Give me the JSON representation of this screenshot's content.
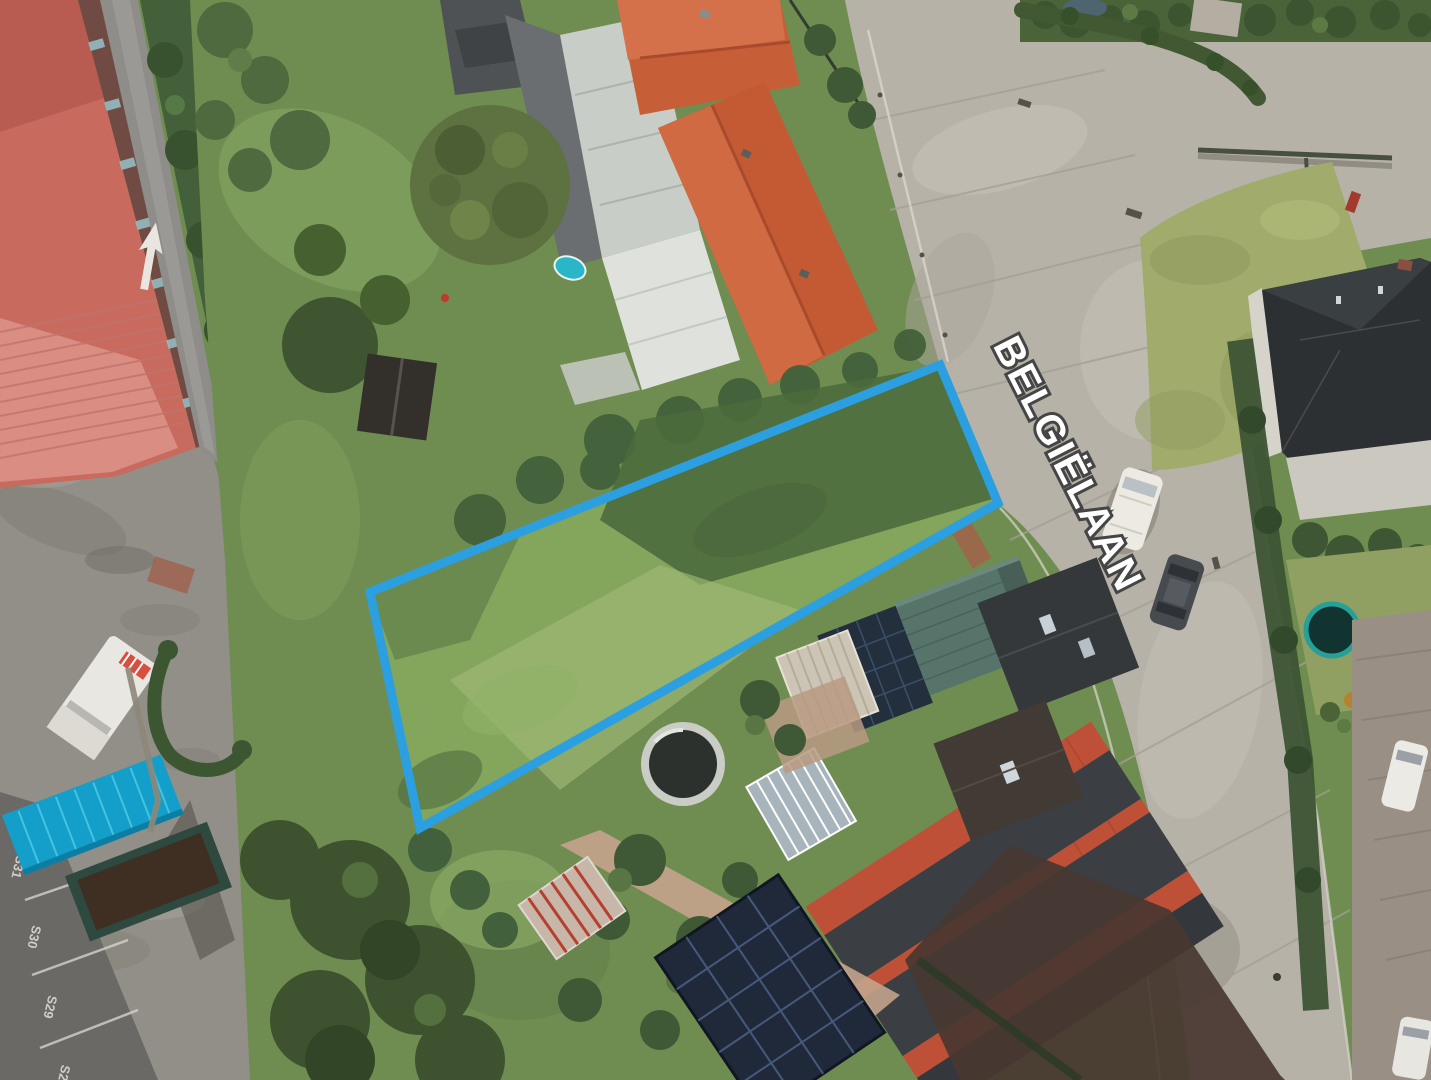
{
  "map": {
    "type": "aerial-photo",
    "labels": {
      "street": "BELGIËLAAN",
      "parking": [
        "S31",
        "S30",
        "S29",
        "S2"
      ]
    },
    "parcel": {
      "outline_color": "#2b9fe0"
    },
    "colors": {
      "road_light": "#b7b2a8",
      "road_dark": "#8e8d89",
      "grass": "#6f8d50",
      "parcel_grass": "#84a55c",
      "roof_orange": "#c45a34",
      "roof_industrial_red": "#c96a5e",
      "roof_dark_slate": "#34383b",
      "carport_teal": "#149fca",
      "solar_panel": "#20293a",
      "street_label_fill": "#ffffff",
      "street_label_outline": "#454545"
    }
  }
}
